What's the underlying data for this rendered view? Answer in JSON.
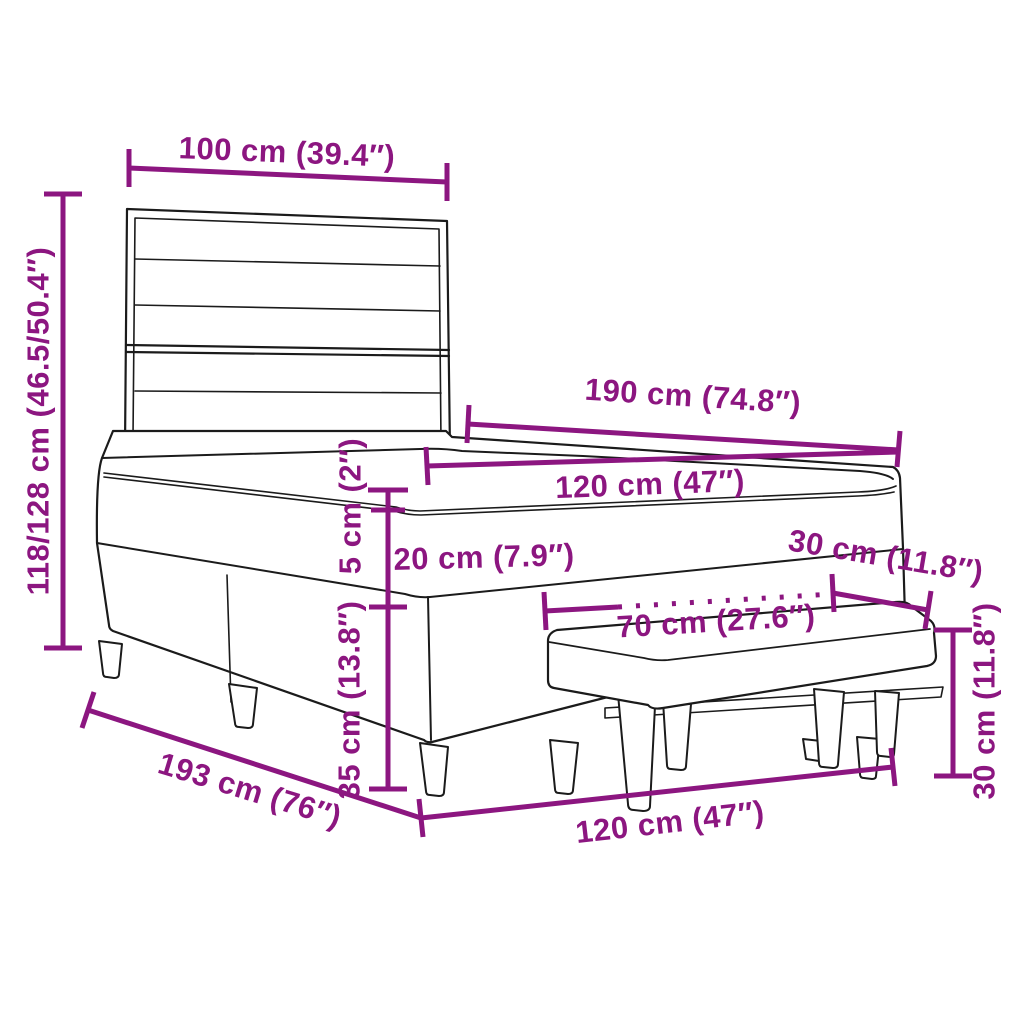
{
  "diagram": {
    "subject": "box spring bed with slatted headboard, mattress topper and upholstered bench",
    "style": "black outline drawing with magenta dimension annotations",
    "colors": {
      "dimension": "#8C1680",
      "outline": "#1B1B1B",
      "background": "#FFFFFF"
    }
  },
  "dims": {
    "headboard_width": "100 cm (39.4″)",
    "total_height": "118/128 cm (46.5/50.4″)",
    "bed_length_top": "190 cm (74.8″)",
    "bed_width_top": "120 cm (47″)",
    "topper_height": "5 cm (2″)",
    "mattress_height": "20 cm (7.9″)",
    "base_height": "35 cm (13.8″)",
    "bench_depth": "30 cm (11.8″)",
    "bench_width": "70 cm (27.6″)",
    "bench_height": "30 cm (11.8″)",
    "bed_width_bottom": "120 cm (47″)",
    "bed_length_bottom": "193 cm (76″)"
  }
}
